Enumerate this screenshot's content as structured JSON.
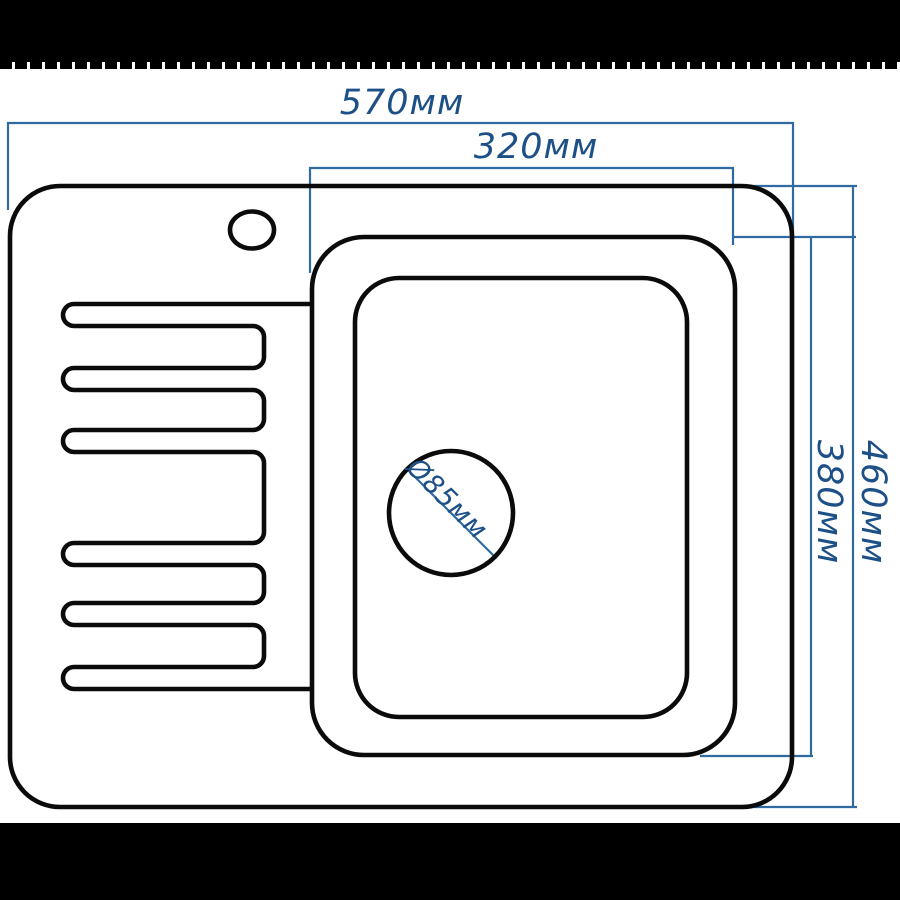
{
  "colors": {
    "background": "#ffffff",
    "band": "#000000",
    "outline": "#0b0b0b",
    "dimension_line": "#2f6ba1",
    "dimension_text": "#1d5086"
  },
  "labels": {
    "overall_width": "570мм",
    "bowl_width": "320мм",
    "overall_depth": "460мм",
    "bowl_depth": "380мм",
    "drain_diameter": "Ø85мм"
  }
}
